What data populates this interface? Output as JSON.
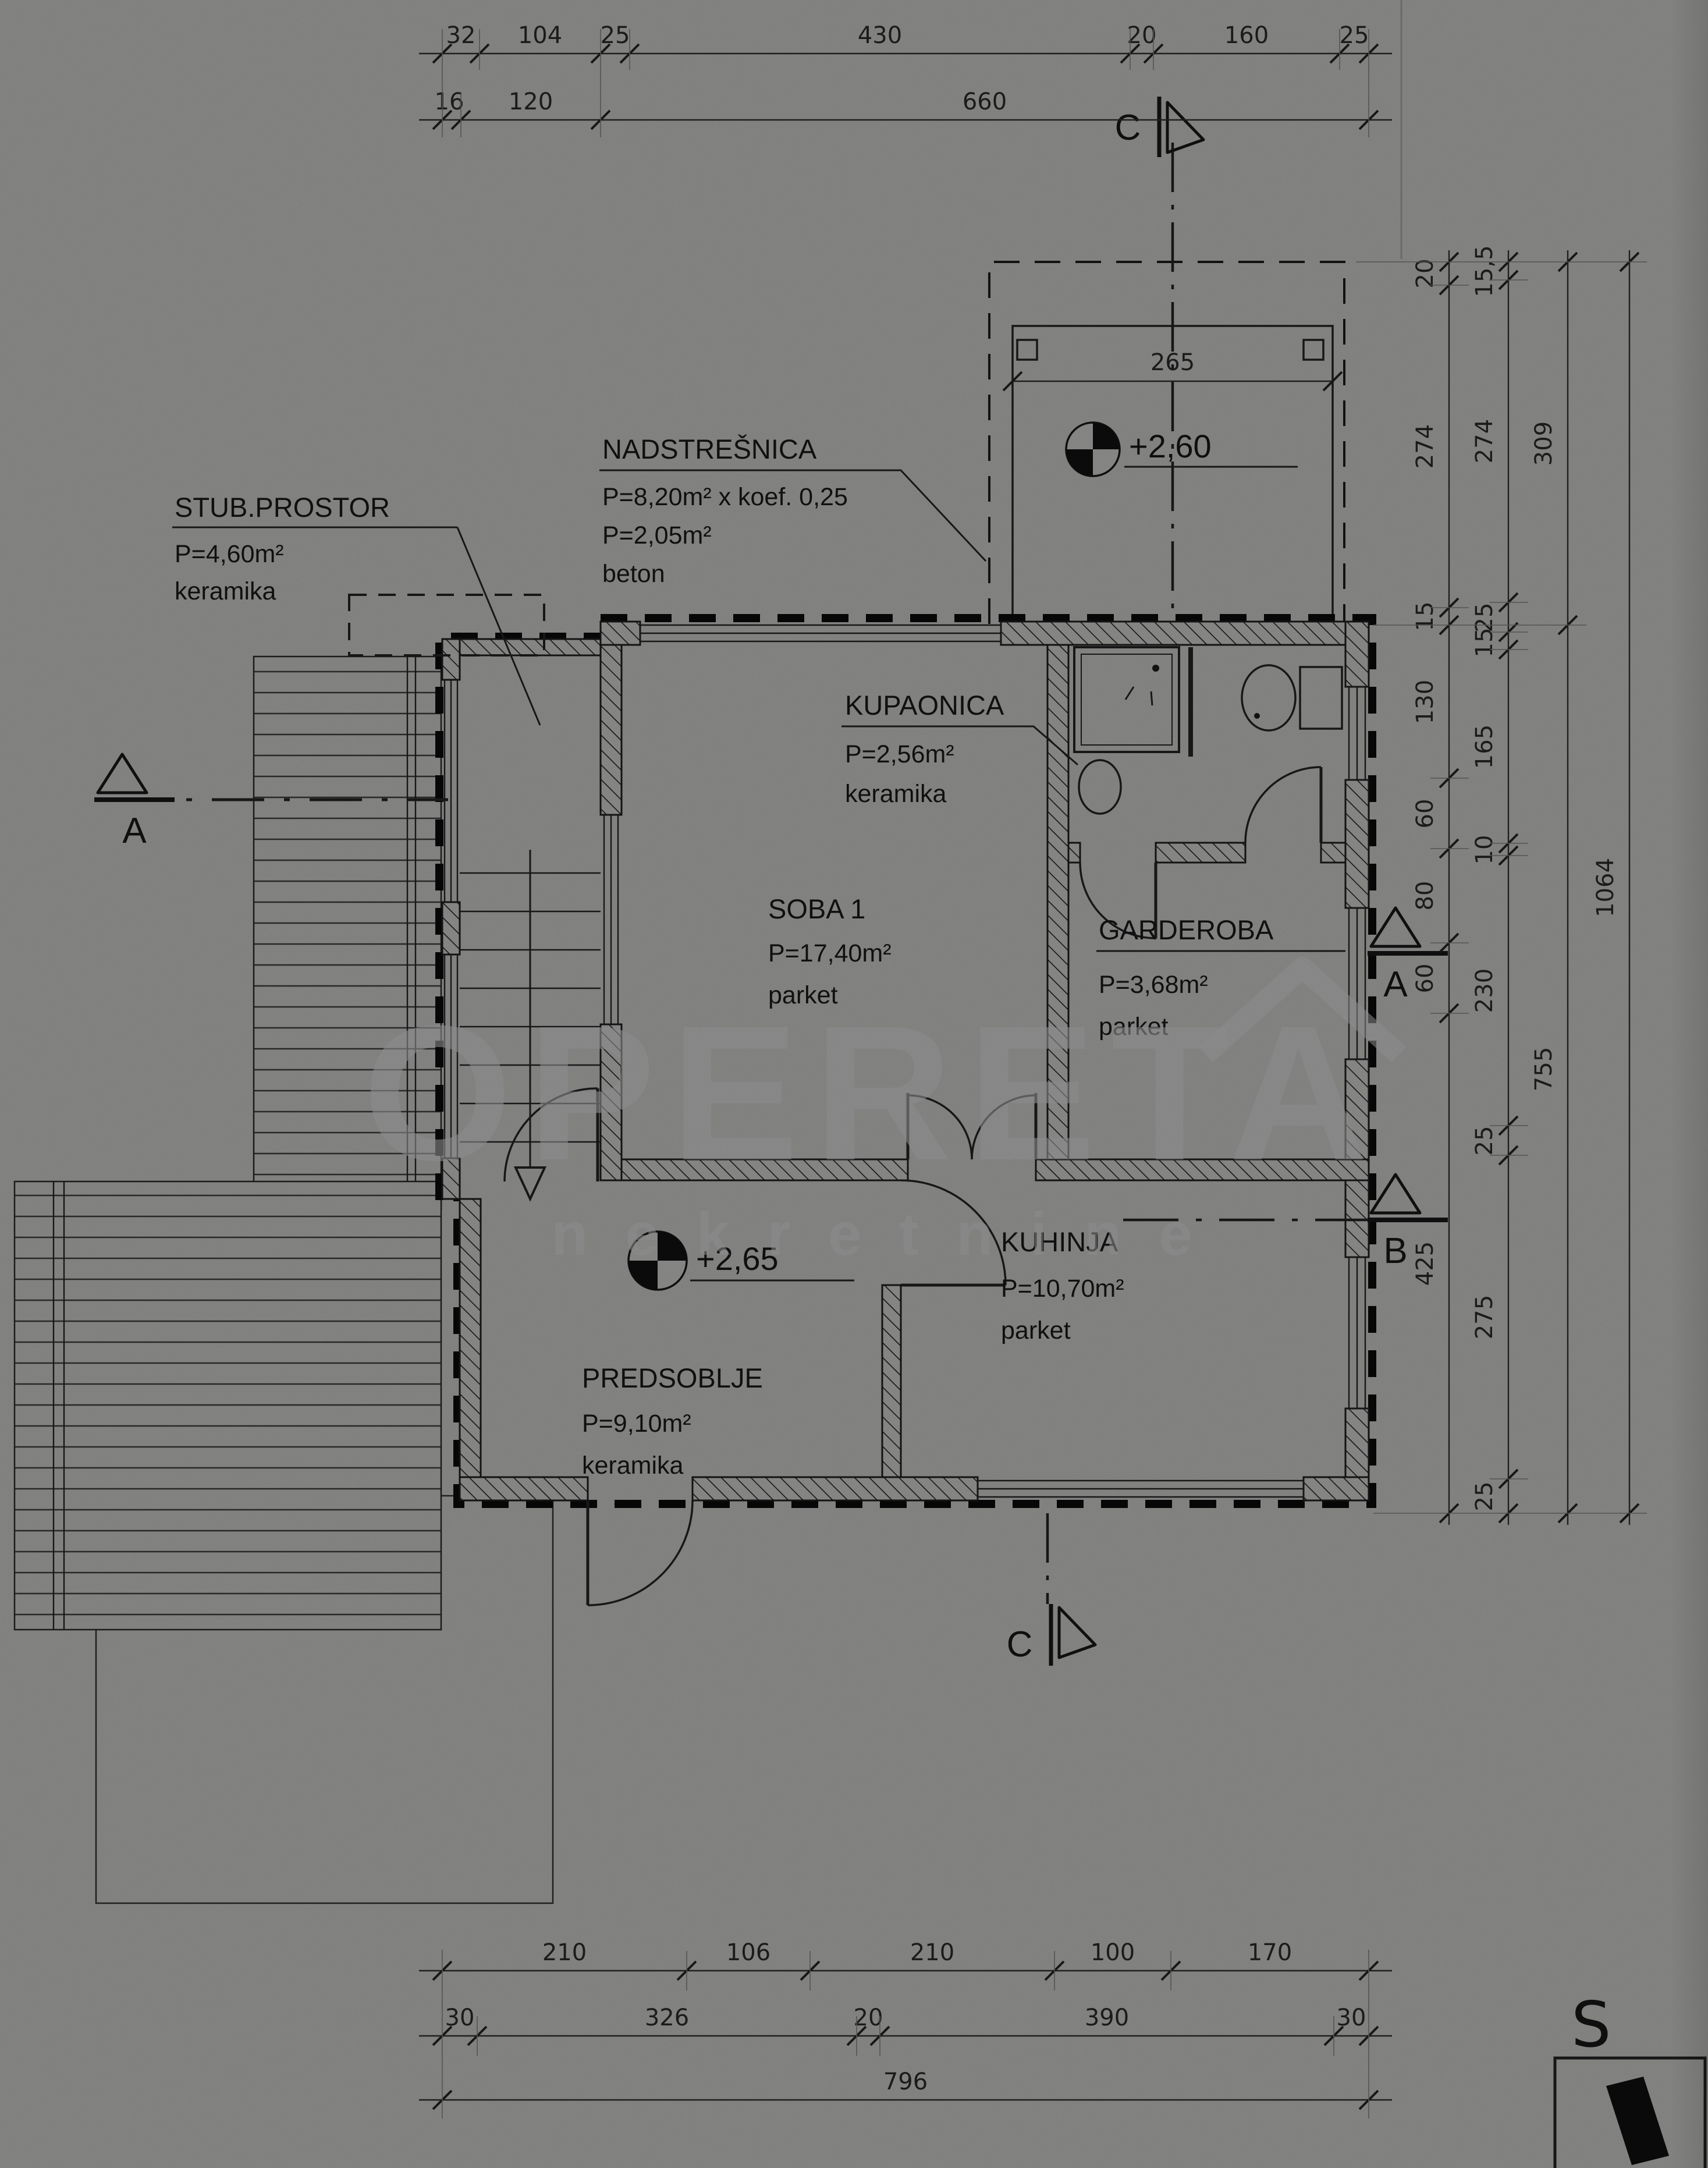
{
  "watermark": {
    "line1": "OPERETA",
    "line2": "nekretnine"
  },
  "rooms": {
    "stub_prostor": {
      "title": "STUB.PROSTOR",
      "line1": "P=4,60m²",
      "line2": "keramika"
    },
    "nadstresnica": {
      "title": "NADSTREŠNICA",
      "line1": "P=8,20m² x koef. 0,25",
      "line2": "P=2,05m²",
      "line3": "beton"
    },
    "kupaonica": {
      "title": "KUPAONICA",
      "line1": "P=2,56m²",
      "line2": "keramika"
    },
    "soba1": {
      "title": "SOBA 1",
      "line1": "P=17,40m²",
      "line2": "parket"
    },
    "garderoba": {
      "title": "GARDEROBA",
      "line1": "P=3,68m²",
      "line2": "parket"
    },
    "predsoblje": {
      "title": "PREDSOBLJE",
      "line1": "P=9,10m²",
      "line2": "keramika"
    },
    "kuhinja": {
      "title": "KUHINJA",
      "line1": "P=10,70m²",
      "line2": "parket"
    }
  },
  "elevations": {
    "hall": "+2,65",
    "carport": "+2,60"
  },
  "sections": {
    "a_left": "A",
    "a_right": "A",
    "b": "B",
    "c_top": "C",
    "c_bottom": "C"
  },
  "north": {
    "label": "S"
  },
  "dimensions": {
    "top_row1": [
      "32",
      "104",
      "25",
      "430",
      "20",
      "160",
      "25"
    ],
    "top_row2": [
      "16",
      "120",
      "660"
    ],
    "carport_width": "265",
    "right_chain1": [
      "20",
      "274",
      "15",
      "130",
      "60",
      "80",
      "60",
      "425"
    ],
    "right_chain2": [
      "15,5",
      "274",
      "25",
      "15",
      "165",
      "10",
      "230",
      "25",
      "275",
      "25"
    ],
    "right_chain3": [
      "309",
      "755"
    ],
    "right_total": "1064",
    "bottom_row1": [
      "210",
      "106",
      "210",
      "100",
      "170"
    ],
    "bottom_row2": [
      "30",
      "326",
      "20",
      "390",
      "30"
    ],
    "bottom_total": "796"
  }
}
